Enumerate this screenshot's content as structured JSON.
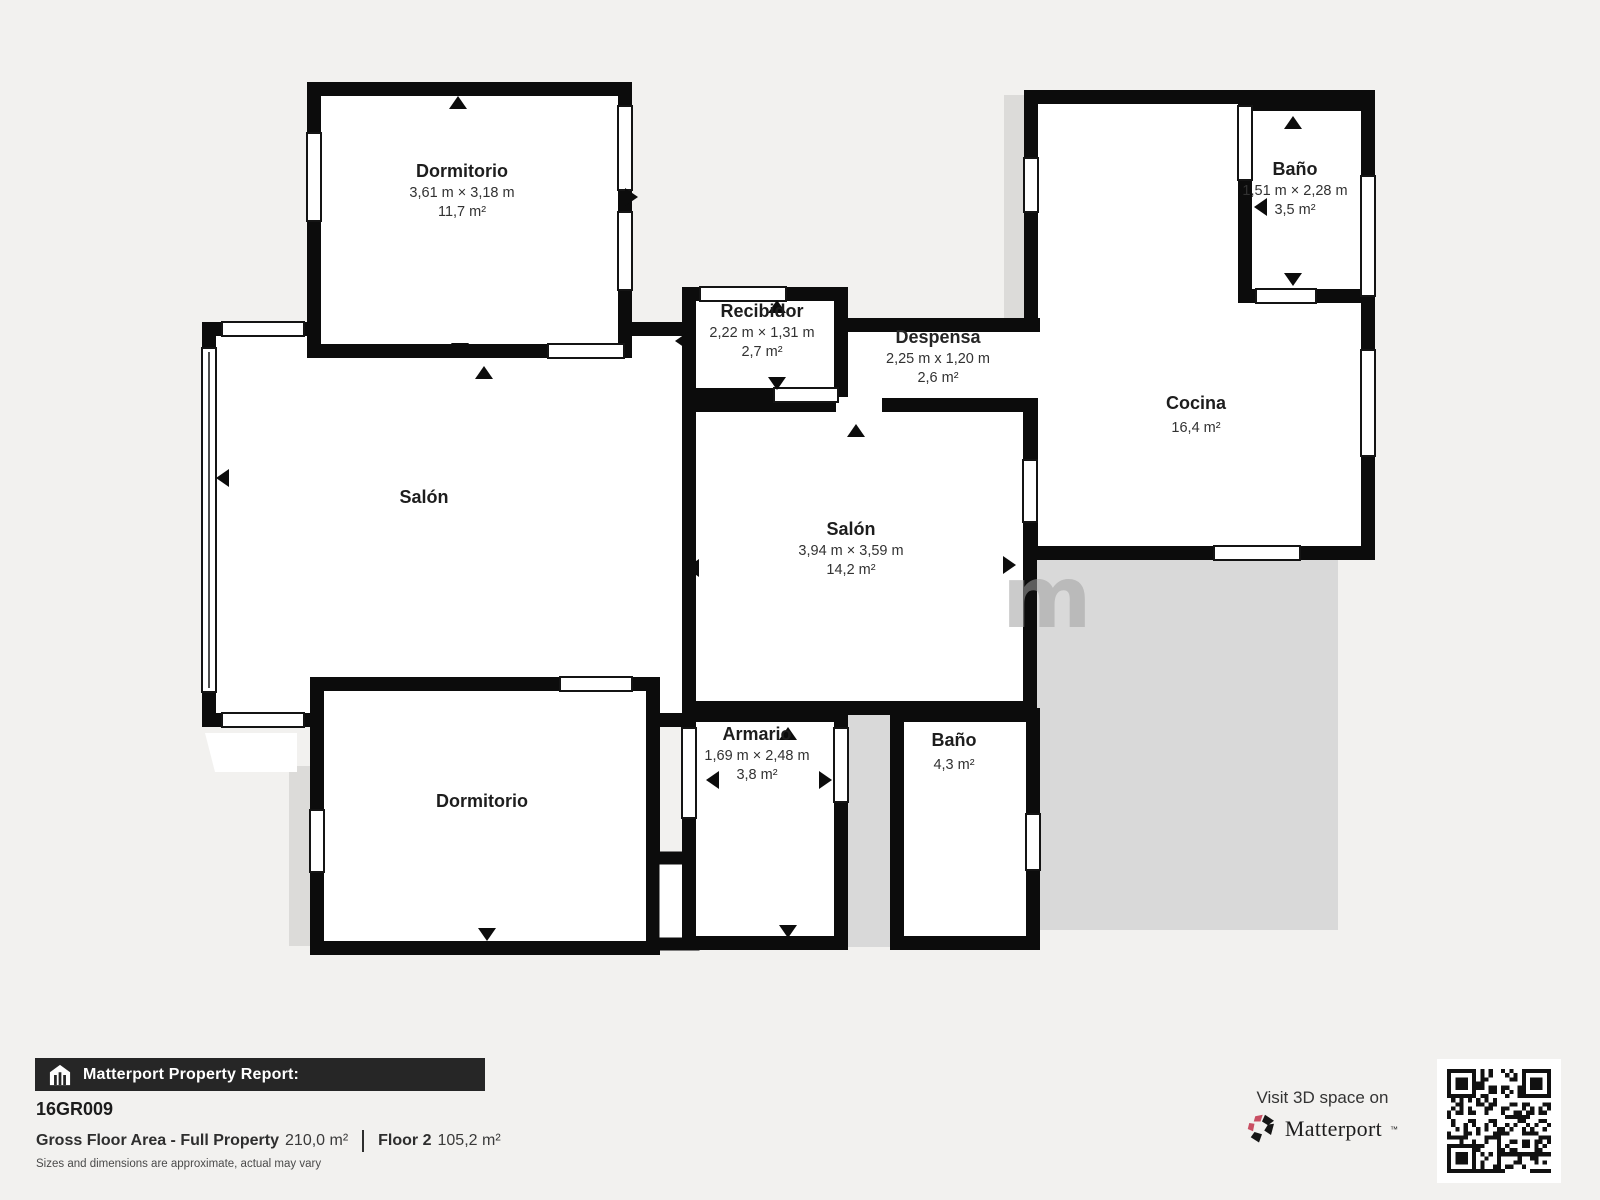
{
  "plan": {
    "rooms": [
      {
        "id": "dorm_tl",
        "name": "Dormitorio",
        "dims": "3,61 m × 3,18 m",
        "area": "11,7 m²"
      },
      {
        "id": "bano_tr",
        "name": "Baño",
        "dims": "1,51 m × 2,28 m",
        "area": "3,5 m²"
      },
      {
        "id": "recibidor",
        "name": "Recibidor",
        "dims": "2,22 m × 1,31 m",
        "area": "2,7 m²"
      },
      {
        "id": "despensa",
        "name": "Despensa",
        "dims": "2,25 m x 1,20 m",
        "area": "2,6 m²"
      },
      {
        "id": "cocina",
        "name": "Cocina",
        "area": "16,4 m²"
      },
      {
        "id": "salon_left",
        "name": "Salón"
      },
      {
        "id": "salon_center",
        "name": "Salón",
        "dims": "3,94 m × 3,59 m",
        "area": "14,2 m²"
      },
      {
        "id": "armario",
        "name": "Armario",
        "dims": "1,69 m × 2,48 m",
        "area": "3,8 m²"
      },
      {
        "id": "bano_bottom",
        "name": "Baño",
        "area": "4,3 m²"
      },
      {
        "id": "dorm_bl",
        "name": "Dormitorio"
      }
    ],
    "watermark": {
      "left": "s",
      "right": "m"
    }
  },
  "footer": {
    "report_label": "Matterport Property Report:",
    "property_id": "16GR009",
    "gross_label": "Gross Floor Area - Full Property",
    "gross_value": "210,0 m²",
    "floor_label": "Floor 2",
    "floor_value": "105,2 m²",
    "disclaimer": "Sizes and dimensions are approximate, actual may vary",
    "visit_label": "Visit 3D space on",
    "brand": "Matterport",
    "brand_mark": "™"
  },
  "colors": {
    "wall": "#0c0c0c",
    "page_bg": "#f2f1ef",
    "floor": "#ffffff",
    "terrace_gray": "#d9d9d9",
    "bar_bg": "#262626",
    "brand_red": "#c94f63"
  }
}
